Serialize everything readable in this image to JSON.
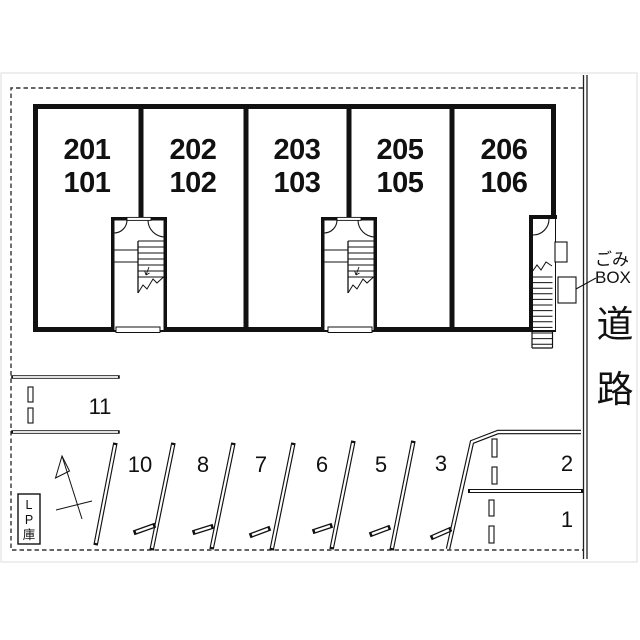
{
  "building": {
    "units": [
      {
        "label": "201\n101"
      },
      {
        "label": "202\n102"
      },
      {
        "label": "203\n103"
      },
      {
        "label": "205\n105"
      },
      {
        "label": "206\n106"
      }
    ]
  },
  "parking": {
    "spaces": [
      {
        "number": "11"
      },
      {
        "number": "10"
      },
      {
        "number": "8"
      },
      {
        "number": "7"
      },
      {
        "number": "6"
      },
      {
        "number": "5"
      },
      {
        "number": "3"
      },
      {
        "number": "2"
      },
      {
        "number": "1"
      }
    ]
  },
  "annotations": {
    "garbage_box_label": "ごみ\nBOX",
    "road_label": "道\n路",
    "lp_storage_label": "L\nP\n庫"
  },
  "colors": {
    "line": "#111111",
    "dashed_border": "#333333",
    "scan_border": "#dcdcdc",
    "background": "#ffffff"
  }
}
